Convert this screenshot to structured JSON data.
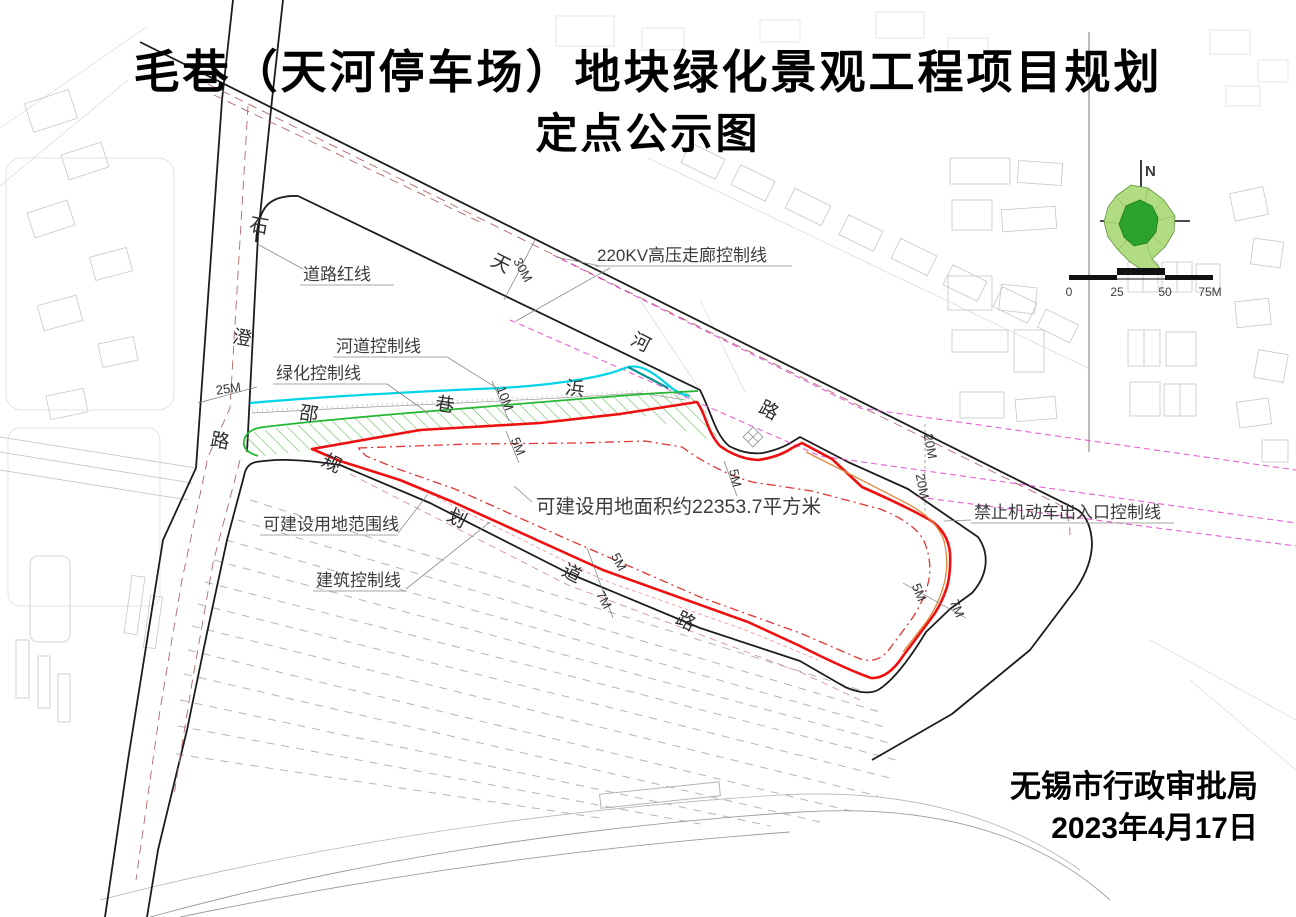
{
  "title": {
    "line1": "毛巷（天河停车场）地块绿化景观工程项目规划",
    "line2": "定点公示图"
  },
  "labels": {
    "road_red": "道路红线",
    "river_ctl": "河道控制线",
    "green_ctl": "绿化控制线",
    "hv": "220KV高压走廊控制线",
    "buildable": "可建设用地范围线",
    "building_ctl": "建筑控制线",
    "no_vehicle": "禁止机动车出入口控制线",
    "area": "可建设用地面积约22353.7平方米"
  },
  "roads": {
    "shicheng": [
      "石",
      "澄",
      "路"
    ],
    "tianhe": [
      "天",
      "河",
      "路"
    ],
    "creek": [
      "邵",
      "巷",
      "浜"
    ],
    "planned": [
      "规",
      "划",
      "道",
      "路"
    ]
  },
  "dims": {
    "w25": "25M",
    "w30": "30M",
    "w10": "10M",
    "w5": "5M",
    "w7": "7M",
    "w20": "20M"
  },
  "compass": {
    "north": "N"
  },
  "scalebar": [
    "0",
    "25",
    "50",
    "75M"
  ],
  "footer": {
    "agency": "无锡市行政审批局",
    "date": "2023年4月17日"
  },
  "colors": {
    "boundary_red": "#ee1010",
    "setback_red": "#e23535",
    "green_line": "#22b832",
    "river_cyan": "#00d4e6",
    "corridor_magenta": "#e54fd0",
    "access_orange": "#e08a40",
    "hatch_green": "#59b84a",
    "inset_outer_green": "#b2dc82",
    "inset_inner_green": "#2ba32b",
    "road_centerline": "#b26a6a"
  }
}
